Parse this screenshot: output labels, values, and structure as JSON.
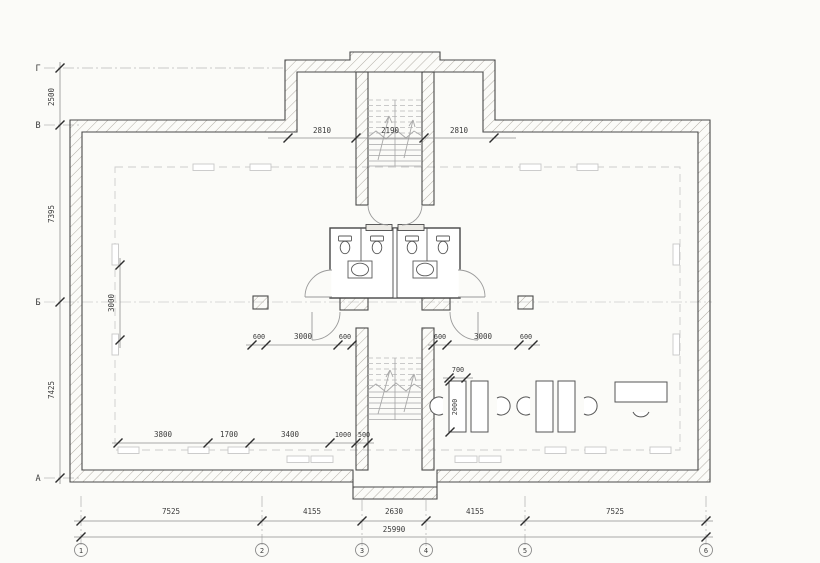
{
  "plan": {
    "axis_rows": [
      {
        "label": "Г"
      },
      {
        "label": "В"
      },
      {
        "label": "Б"
      },
      {
        "label": "А"
      }
    ],
    "axis_cols": [
      {
        "label": "1"
      },
      {
        "label": "2"
      },
      {
        "label": "3"
      },
      {
        "label": "4"
      },
      {
        "label": "5"
      },
      {
        "label": "6"
      }
    ],
    "dims": {
      "left_vertical": [
        "2500",
        "7395",
        "7425"
      ],
      "top_inner": [
        "2810",
        "2190",
        "2810"
      ],
      "mid_left": [
        "600",
        "3000",
        "600"
      ],
      "mid_right": [
        "600",
        "3000",
        "600"
      ],
      "room_left_vertical": "3000",
      "bottom_inner": [
        "3800",
        "1700",
        "3400",
        "1000",
        "500"
      ],
      "bottom_spans": [
        "7525",
        "4155",
        "2630",
        "4155",
        "7525"
      ],
      "bottom_total": "25990",
      "desk_width": "700",
      "desk_depth": "2000"
    },
    "colors": {
      "paper": "#fbfbf8",
      "wall_line": "#4a4a4a",
      "hatch": "#b3aea6",
      "dim_text": "#3b3b3b",
      "dim_line": "#8f8f8f",
      "grid_dash": "#cdcdcd",
      "axis_dash": "#b8b8b8"
    }
  }
}
